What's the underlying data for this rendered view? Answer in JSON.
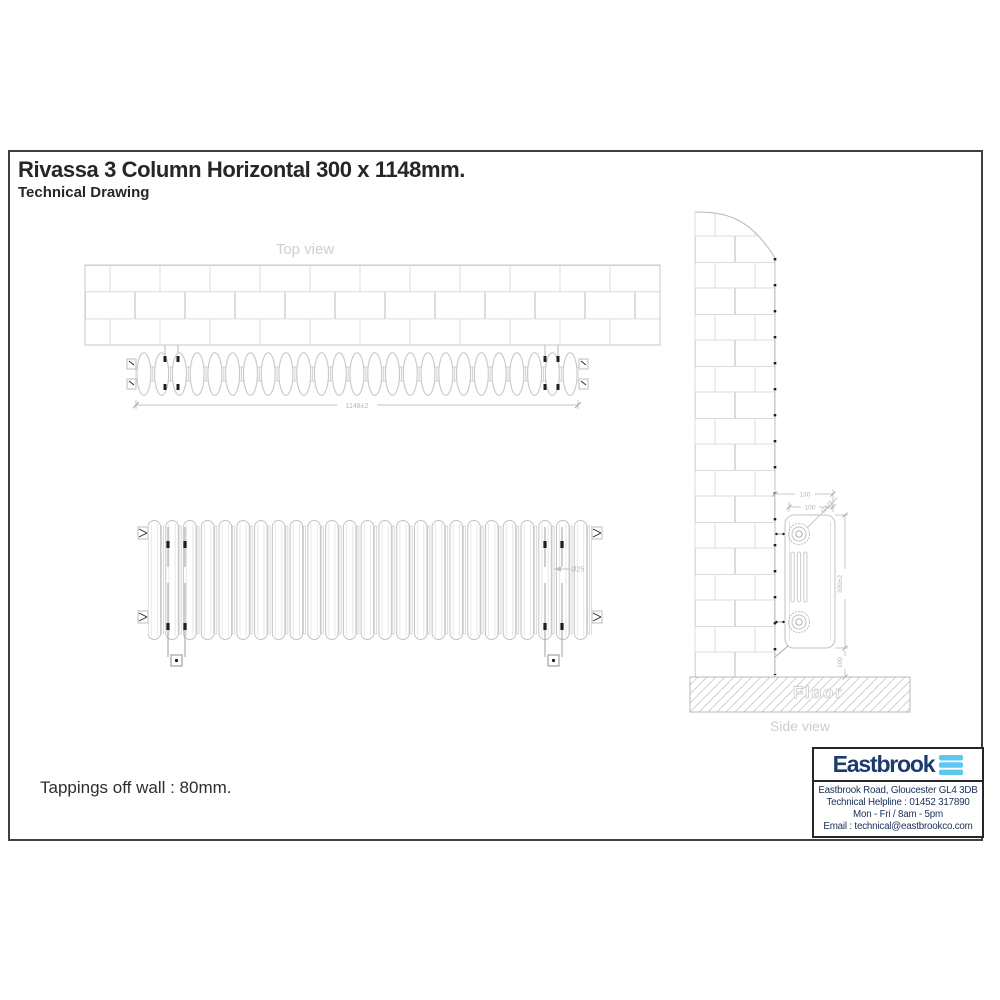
{
  "header": {
    "title": "Rivassa 3 Column Horizontal 300 x 1148mm.",
    "subtitle": "Technical Drawing"
  },
  "note": {
    "tappings": "Tappings off wall : 80mm."
  },
  "top_view": {
    "label": "Top view",
    "width_dim": "1148±2"
  },
  "front_view": {
    "tube_diameter_dim": "Ø25"
  },
  "side_view": {
    "label": "Side view",
    "floor_label": "Floor",
    "overall_depth_dim": "130",
    "column_depth_dim": "100",
    "tapping_thread_dim": "G1/2",
    "height_dim": "300±2",
    "floor_clearance_dim": "100"
  },
  "brand_box": {
    "name": "Eastbrook",
    "lines": [
      "Eastbrook Road, Gloucester GL4 3DB",
      "Technical Helpline : 01452 317890",
      "Mon - Fri / 8am - 5pm",
      "Email : technical@eastbrookco.com"
    ]
  },
  "colors": {
    "brand_navy": "#1c3c6e",
    "brand_light_blue": "#5ec7f0",
    "drawing_line": "#c2c2c2",
    "drawing_label": "#cfcfcf",
    "ink": "#262626"
  }
}
